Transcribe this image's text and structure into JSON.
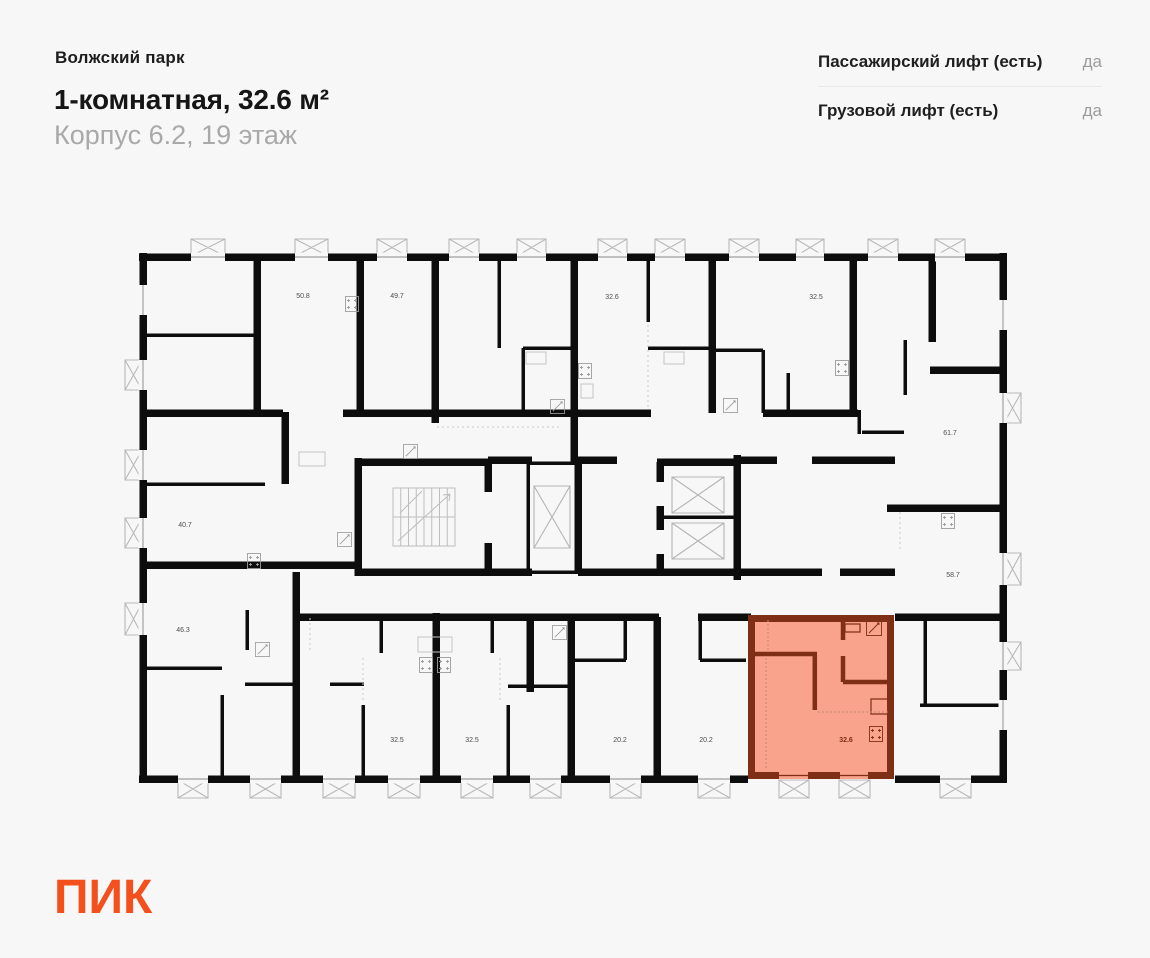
{
  "header": {
    "project": "Волжский парк",
    "title": "1-комнатная, 32.6 м²",
    "subtitle": "Корпус 6.2, 19 этаж"
  },
  "lifts": {
    "rows": [
      {
        "label": "Пассажирский лифт (есть)",
        "value": "да"
      },
      {
        "label": "Грузовой лифт (есть)",
        "value": "да"
      }
    ]
  },
  "floorplan": {
    "highlight": {
      "fill": "#F9A28C",
      "wall": "#7E2F15",
      "label": "32.6"
    },
    "rooms": [
      {
        "label": "50.8",
        "x": 303,
        "y": 296,
        "highlighted": false
      },
      {
        "label": "49.7",
        "x": 397,
        "y": 296,
        "highlighted": false
      },
      {
        "label": "32.6",
        "x": 612,
        "y": 297,
        "highlighted": false
      },
      {
        "label": "32.5",
        "x": 816,
        "y": 297,
        "highlighted": false
      },
      {
        "label": "61.7",
        "x": 950,
        "y": 433,
        "highlighted": false
      },
      {
        "label": "40.7",
        "x": 185,
        "y": 525,
        "highlighted": false
      },
      {
        "label": "58.7",
        "x": 953,
        "y": 575,
        "highlighted": false
      },
      {
        "label": "46.3",
        "x": 183,
        "y": 630,
        "highlighted": false
      },
      {
        "label": "32.5",
        "x": 397,
        "y": 740,
        "highlighted": false
      },
      {
        "label": "32.5",
        "x": 472,
        "y": 740,
        "highlighted": false
      },
      {
        "label": "20.2",
        "x": 620,
        "y": 740,
        "highlighted": false
      },
      {
        "label": "20.2",
        "x": 706,
        "y": 740,
        "highlighted": false
      },
      {
        "label": "32.6",
        "x": 846,
        "y": 740,
        "highlighted": true
      }
    ]
  },
  "logo": {
    "text": "ПИК",
    "color": "#F4501E"
  }
}
